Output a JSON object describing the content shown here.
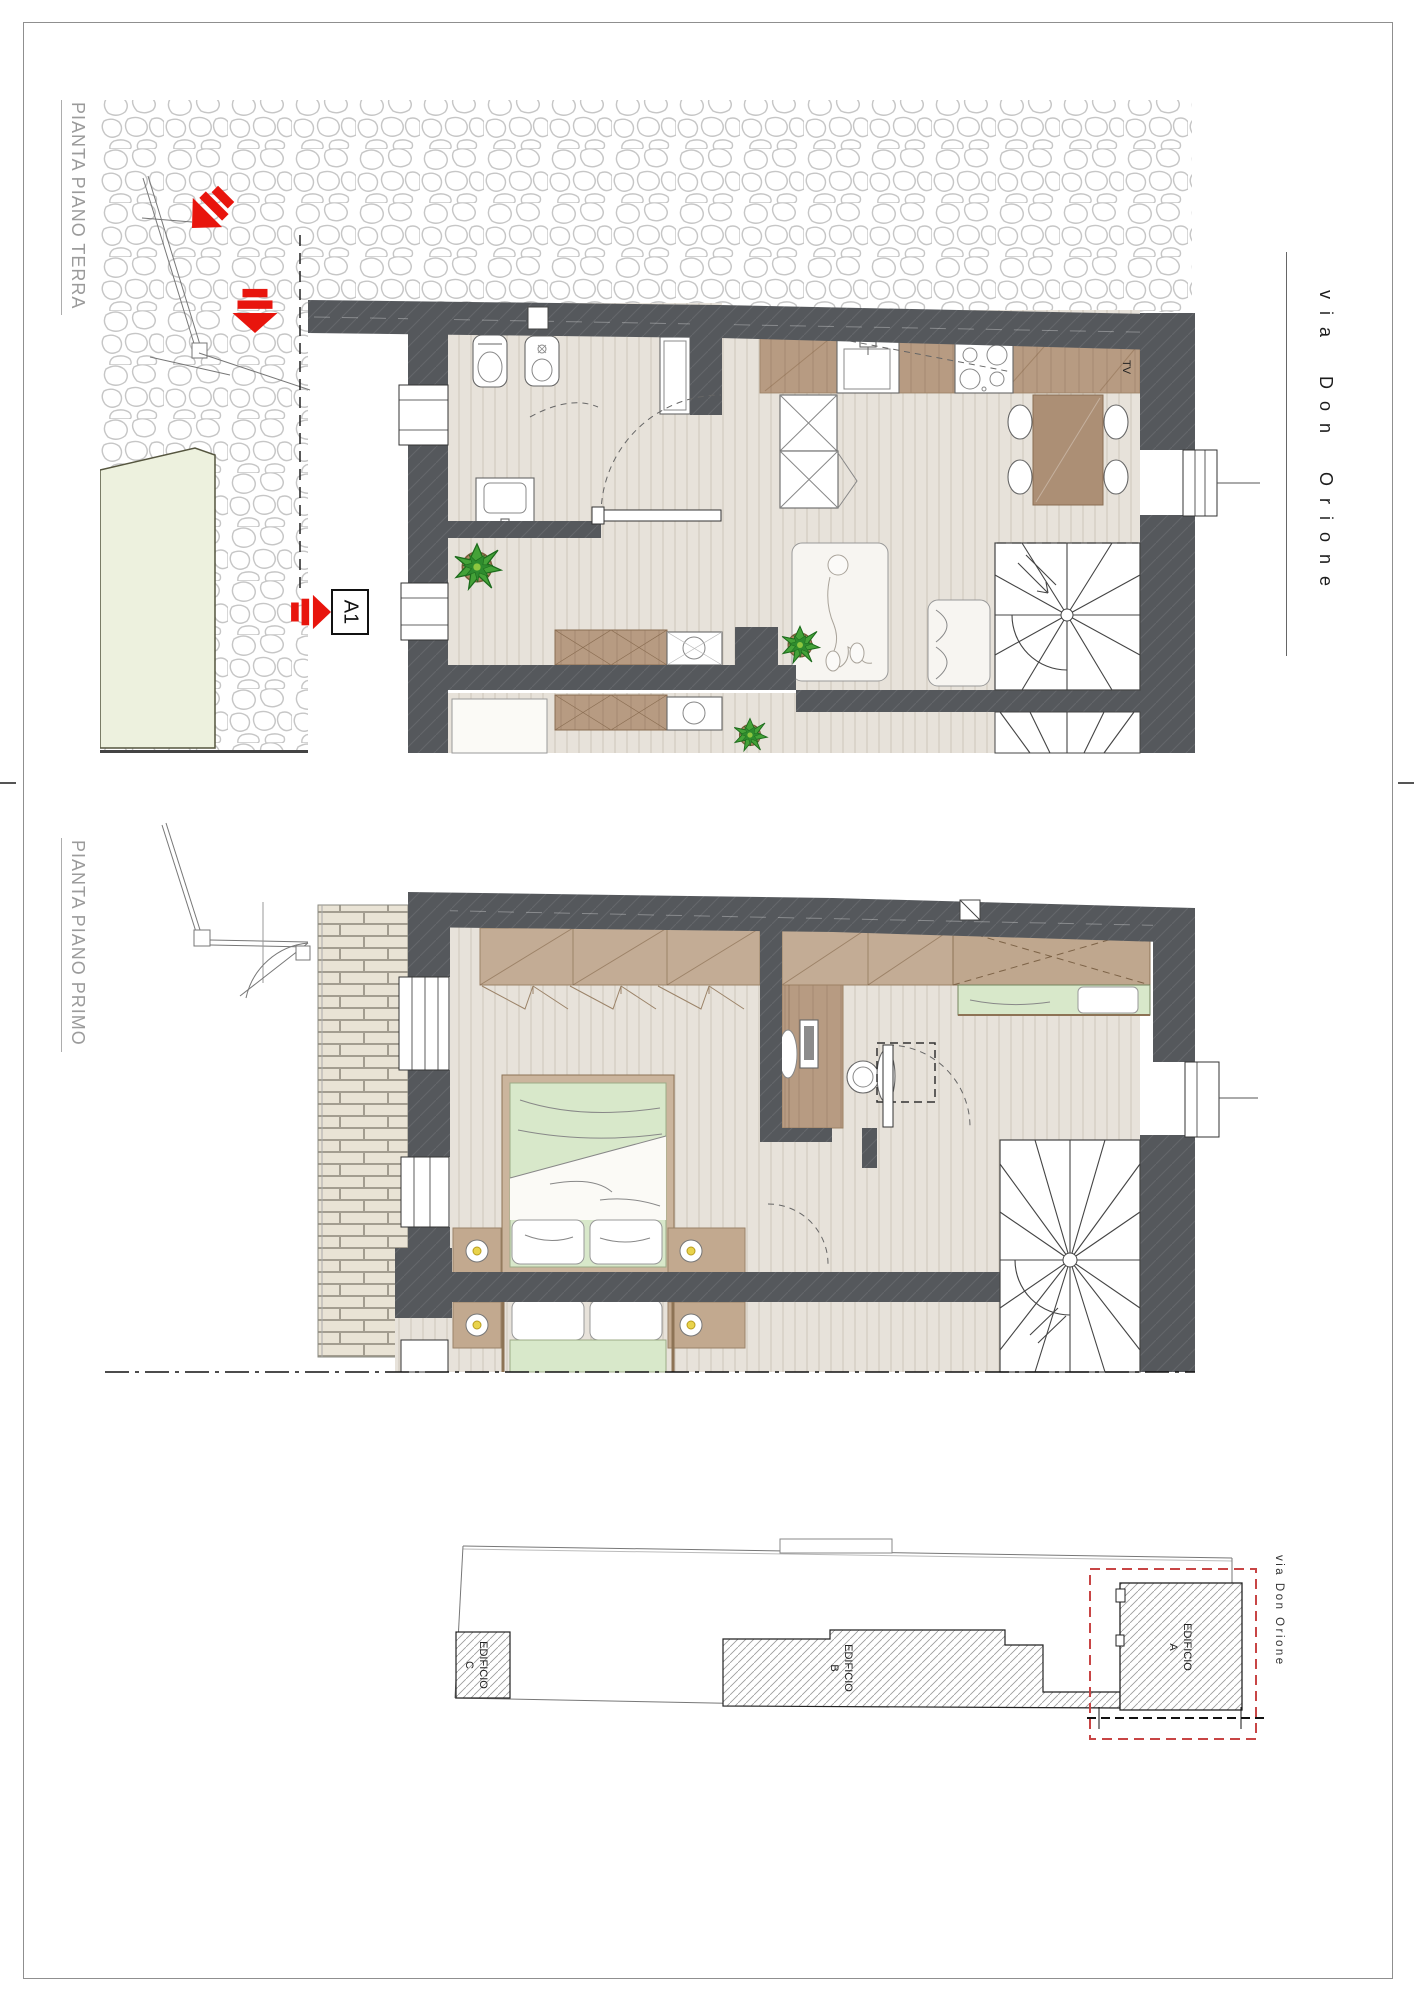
{
  "sheet": {
    "labels": {
      "ground_floor": "PIANTA PIANO TERRA",
      "first_floor": "PIANTA PIANO PRIMO",
      "street": "via Don Orione"
    },
    "section_marker": "A1",
    "tv_label": "TV"
  },
  "site_plan": {
    "street_label": "via Don Orione",
    "buildings": [
      {
        "name": "EDIFICIO",
        "letter": "A"
      },
      {
        "name": "EDIFICIO",
        "letter": "B"
      },
      {
        "name": "EDIFICIO",
        "letter": "C"
      }
    ]
  },
  "colors": {
    "wall": "#55585c",
    "floor": "#e7e2da",
    "wood": "#b79b82",
    "wardrobe": "#c3ac95",
    "bed_green": "#d8e8ca",
    "plant_green": "#44a238",
    "courtyard_green": "#edf1de",
    "accent_red": "#e8150d",
    "boundary_red_dashed": "#c84545",
    "label_gray": "#9b9b9b"
  }
}
